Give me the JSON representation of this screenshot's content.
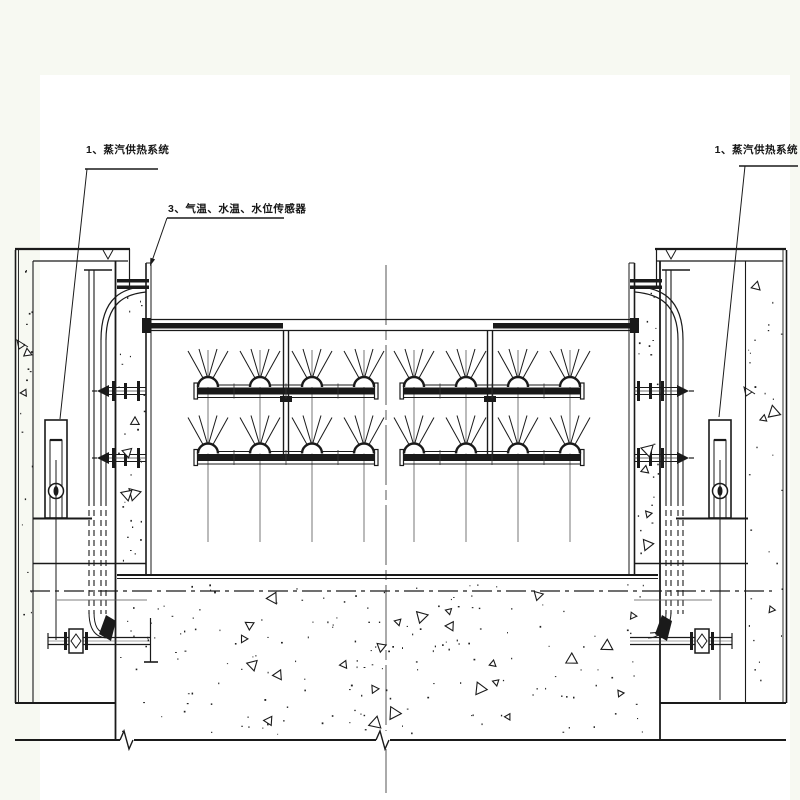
{
  "page": {
    "background": "#ffffff",
    "margin_tint": "#f7f9f2",
    "line_color": "#1a1a1a"
  },
  "labels": {
    "steam_left": {
      "text": "1、蒸汽供热系统"
    },
    "sensors": {
      "text": "3、气温、水温、水位传感器"
    },
    "steam_right": {
      "text": "1、蒸汽供热系统"
    }
  },
  "drawing": {
    "type": "engineering-cross-section",
    "description_counts": {
      "spray_pipe_rows": 2,
      "pipes_per_row": 2,
      "nozzles_per_pipe": 4,
      "heater_units": 2,
      "wall_flange_connections": 4,
      "lower_valves": 2
    }
  }
}
